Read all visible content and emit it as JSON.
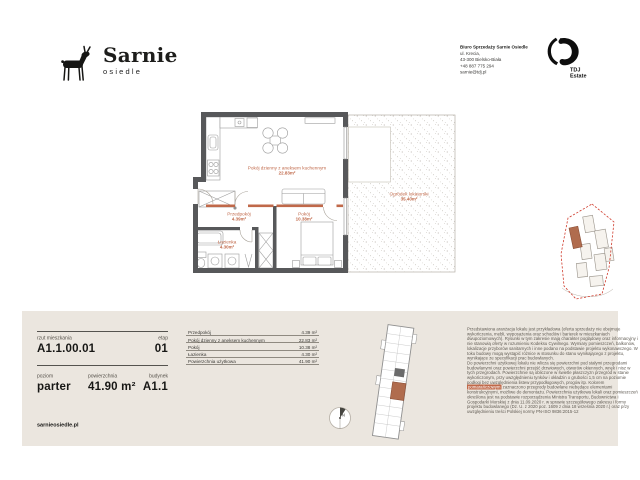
{
  "brand": {
    "name": "Sarnie",
    "tagline": "osiedle"
  },
  "developer": {
    "abbr": "TDJ",
    "name": "Estate"
  },
  "contact": {
    "title": "Biuro Sprzedaży Sarnie Osiedle",
    "line1": "ul. Krecia,",
    "line2": "43-300 Bielsko-Biała",
    "line3": "+48 887 775 294",
    "line4": "sarnie@tdj.pl"
  },
  "plan": {
    "living": {
      "name": "Pokój dzienny z aneksem kuchennym",
      "area": "22.83m²"
    },
    "hall": {
      "name": "Przedpokój",
      "area": "4.39m²"
    },
    "bedroom": {
      "name": "Pokój",
      "area": "10.38m²"
    },
    "bathroom": {
      "name": "Łazienka",
      "area": "4.30m²"
    },
    "garden": {
      "name": "Ogródek lokatorski",
      "area": "35.40m²"
    }
  },
  "info": {
    "unit_label": "rzut mieszkania",
    "unit": "A1.1.00.01",
    "stage_label": "etap",
    "stage": "01",
    "level_label": "poziom",
    "level": "parter",
    "area_label": "powierzchnia",
    "area": "41.90 m²",
    "building_label": "budynek",
    "building": "A1.1",
    "website": "sarnieosiedle.pl"
  },
  "rooms_table": {
    "rows": [
      {
        "label": "Przedpokój",
        "value": "4.39 m²"
      },
      {
        "label": "Pokój dzienny z aneksem kuchennym",
        "value": "22.83 m²"
      },
      {
        "label": "Pokój",
        "value": "10.38 m²"
      },
      {
        "label": "Łazienka",
        "value": "4.30 m²"
      },
      {
        "label": "Powierzchnia użytkowa",
        "value": "41.90 m²"
      }
    ]
  },
  "compass": {
    "north": "N"
  },
  "disclaimer": {
    "part1": "Przedstawiona aranżacja lokalu jest przykładowa (oferta sprzedaży nie obejmuje wykończenia, mebli, wyposażenia oraz schodów i barierek w mieszkaniach dwupoziomowych). Rysunki w tym zakresie mają charakter poglądowy oraz informacyjny i nie stanowią oferty w rozumieniu Kodeksu Cywilnego. Wymiary pomieszczeń, balkonów, lokalizacje przyborów sanitarnych i inne podano na podstawie projektu wykonawczego. W toku budowy mogą wystąpić różnice w stosunku do stanu wynikającego z projektu, wynikające ze specyfikacji prac budowlanych.\nDo powierzchni użytkowej lokalu nie wlicza się powierzchni pod stałymi przegrodami budowlanymi oraz powierzchni przejść drzwiowych, otworów okiennych, wnęk i nisz w tych przegrodach. Powierzchnie są obliczone w świetle płaszczyzn przegród w stanie wykończonym, przy uwzględnieniu tynków i okładzin o grubości 1,5 cm na poziomie podłogi bez uwzględnienia listew przypodłogowych, progów itp. Kolorem ",
    "highlight": "pomarańczowym",
    "part2": " zaznaczono przegrody budowlane niebędące elementami konstrukcyjnymi, możliwe do demontażu. Powierzchnia użytkowa lokali oraz pomieszczeń określona jest na podstawie rozporządzenia Ministra Transportu, Budownictwa i Gospodarki Morskiej z dnia 11.09.2020 r. w sprawie szczegółowego zakresu i formy projektu budowlanego (Dz. U. z 2020 poz. 1609 z dnia 18 września 2020 r.) oraz przy uwzględnieniu treści Polskiej normy PN-ISO 9836:2015-12"
  },
  "colors": {
    "accent": "#c0694a",
    "wall": "#57585a",
    "panel_bg": "#ebe6df",
    "boundary_red": "#cf3a2b",
    "unit_fill": "#b06c4e"
  }
}
